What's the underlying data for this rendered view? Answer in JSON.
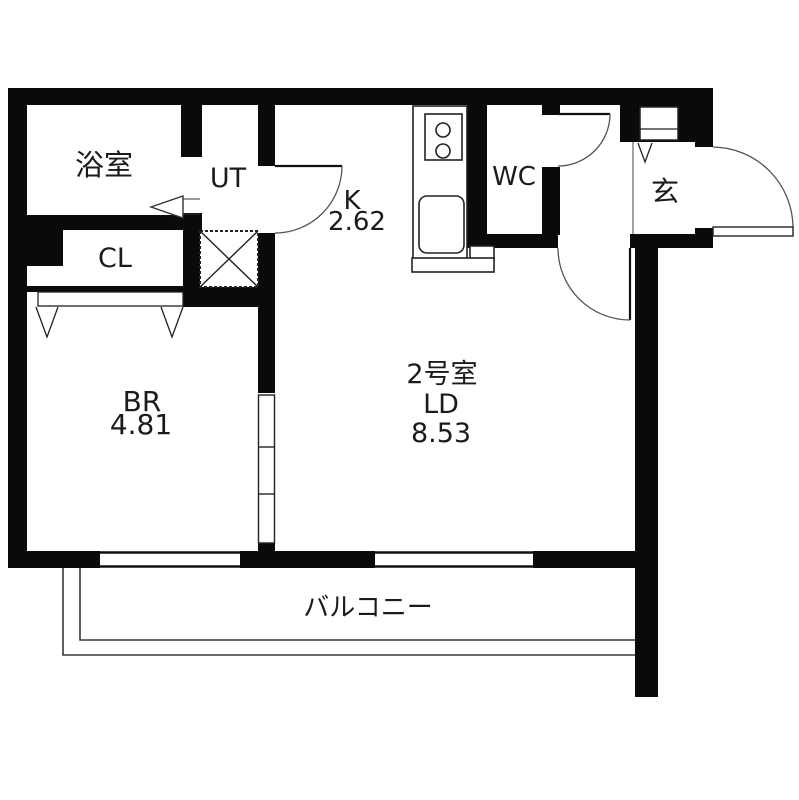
{
  "plan": {
    "type": "apartment-floor-plan",
    "rooms": {
      "bathroom": {
        "label": "浴室"
      },
      "utility": {
        "label": "UT"
      },
      "kitchen": {
        "label": "K",
        "area": "2.62"
      },
      "toilet": {
        "label": "WC"
      },
      "entrance": {
        "label": "玄"
      },
      "closet": {
        "label": "CL"
      },
      "bedroom": {
        "label": "BR",
        "area": "4.81"
      },
      "living_dining": {
        "unit": "2号室",
        "label": "LD",
        "area": "8.53"
      },
      "balcony": {
        "label": "バルコニー"
      }
    },
    "colors": {
      "wall": "#0a0a0a",
      "background": "#ffffff",
      "fixture_line": "#222222",
      "text": "#1b1b1b"
    }
  }
}
